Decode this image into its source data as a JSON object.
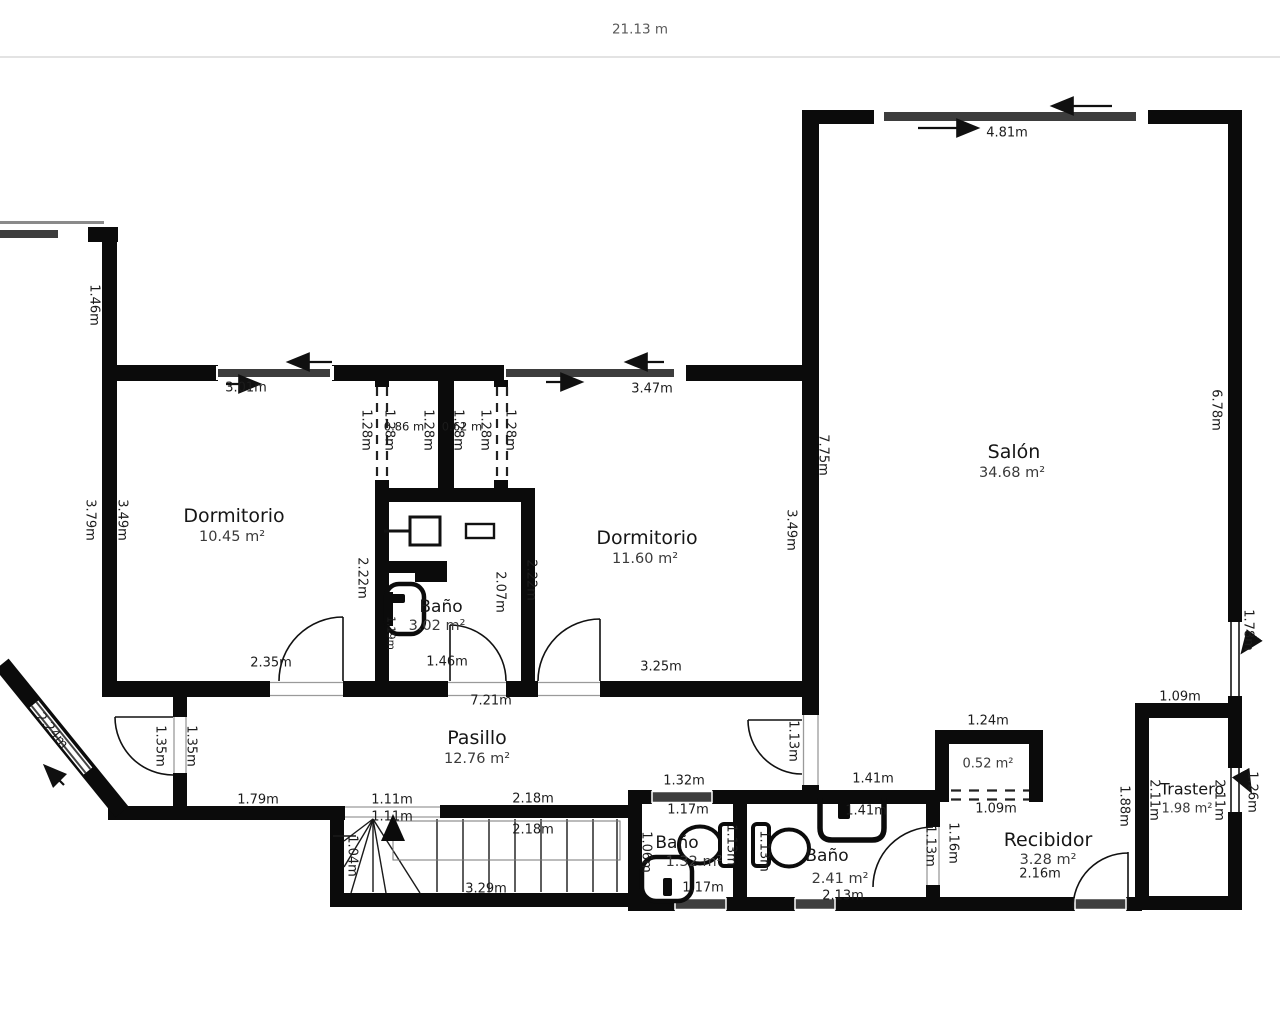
{
  "scale": {
    "total_width": "21.13 m"
  },
  "rooms": {
    "dormitorio1": {
      "name": "Dormitorio",
      "area": "10.45 m²"
    },
    "dormitorio2": {
      "name": "Dormitorio",
      "area": "11.60 m²"
    },
    "salon": {
      "name": "Salón",
      "area": "34.68 m²"
    },
    "banio_top": {
      "name": "Baño",
      "area": "3.02 m²"
    },
    "pasillo": {
      "name": "Pasillo",
      "area": "12.76 m²"
    },
    "banio_small": {
      "name": "Baño",
      "area": "1.32 m²"
    },
    "banio_bottom": {
      "name": "Baño",
      "area": "2.41 m²"
    },
    "recibidor": {
      "name": "Recibidor",
      "area": "3.28 m²"
    },
    "trastero": {
      "name": "Trastero",
      "area": "1.98 m²"
    },
    "armario": {
      "area": "0.52 m²"
    }
  },
  "dims": {
    "d481": "4.81m",
    "d146": "1.46m",
    "d301": "3.01m",
    "d347": "3.47m",
    "d128": "1.28m",
    "d086": "0.86 m",
    "d062": "0.62 m",
    "d775": "7.75m",
    "d678": "6.78m",
    "d379": "3.79m",
    "d349": "3.49m",
    "d222": "2.22m",
    "d207": "2.07m",
    "d119": "1.19m",
    "d235": "2.35m",
    "d325": "3.25m",
    "d721": "7.21m",
    "d224": "2.24m",
    "d135": "1.35m",
    "d179": "1.79m",
    "d111": "1.11m",
    "d218": "2.18m",
    "d104": "1.04m",
    "d329": "3.29m",
    "d106": "1.06m",
    "d132": "1.32m",
    "d117": "1.17m",
    "d113": "1.13m",
    "d141": "1.41m",
    "d213": "2.13m",
    "d116": "1.16m",
    "d124": "1.24m",
    "d109": "1.09m",
    "d216": "2.16m",
    "d188": "1.88m",
    "d178": "1.78m",
    "d126": "1.26m",
    "d211": "2.11m"
  },
  "colors": {
    "wall": "#0b0b0b",
    "window": "#3d3d3d",
    "accent_text": "#1c1c1c"
  }
}
